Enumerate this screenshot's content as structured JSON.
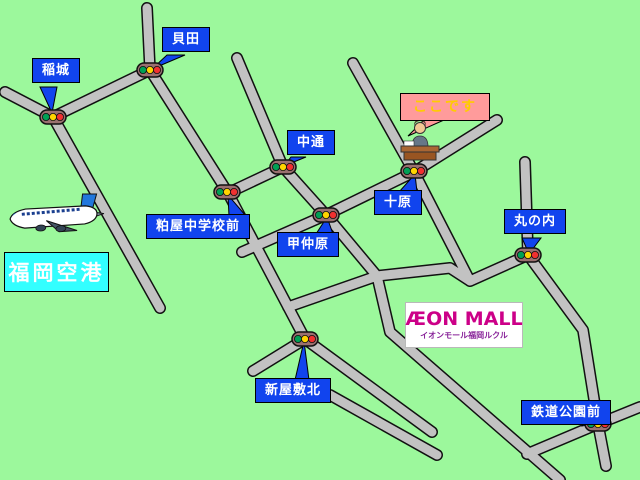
{
  "labels": {
    "inagi": "稲城",
    "kaida": "貝田",
    "nakadori": "中通",
    "kasuya_chugakko_mae": "粕屋中学校前",
    "konakabaru": "甲仲原",
    "tobaru": "十原",
    "marunouchi": "丸の内",
    "shinyashiki_kita": "新屋敷北",
    "tetsudo_koen_mae": "鉄道公園前"
  },
  "callouts": {
    "here": "ここです"
  },
  "airport": {
    "name": "福岡空港"
  },
  "mall": {
    "logo": "ÆON MALL",
    "name": "イオンモール福岡ルクル"
  },
  "colors": {
    "background": "#9cf89c",
    "road": "#c2c2c2",
    "road_outline": "#111111",
    "label_bubble": "#1144ee",
    "here_bubble": "#ff9b9b",
    "here_text": "#ffcc00",
    "airport_box": "#33ffff",
    "mall_logo": "#cc0088",
    "signal_green": "#00a055",
    "signal_yellow": "#ffd400",
    "signal_red": "#f03030"
  }
}
